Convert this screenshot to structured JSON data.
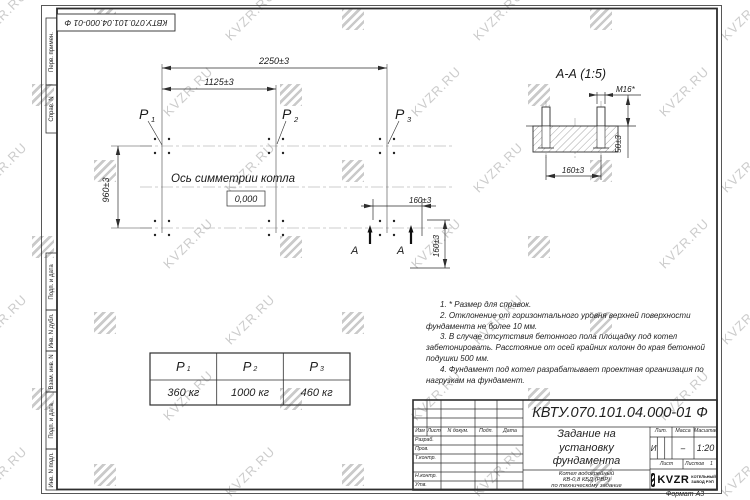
{
  "watermark": {
    "text": "KVZR.RU"
  },
  "corner_stamp": {
    "doc_number": "КВТУ.070.101.04.000-01 Ф"
  },
  "margin_fields": [
    "Перв. примен.",
    "Справ. N",
    "Подп. и дата",
    "Инв. N дубл.",
    "Взам. инв. N",
    "Подп. и дата",
    "Инв. N подл."
  ],
  "plan": {
    "dim_width": "2250±3",
    "dim_width_half": "1125±3",
    "dim_height": "960±3",
    "points": [
      {
        "name": "P",
        "sub": "1"
      },
      {
        "name": "P",
        "sub": "2"
      },
      {
        "name": "P",
        "sub": "3"
      }
    ],
    "axis_label": "Ось симметрии котла",
    "zero_level": "0,000",
    "dim_bolt_h": "160±3",
    "dim_bolt_v": "160±3",
    "section_letter": "А"
  },
  "section_view": {
    "title": "А-А (1:5)",
    "bolt_label": "М16*",
    "dim_protrusion": "50±3",
    "dim_spacing": "160±3"
  },
  "notes": [
    "1. * Размер для справок.",
    "2. Отклонение от горизонтального уровня верхней поверхности фундамента не более 10 мм.",
    "3. В случае отсутствия бетонного пола площадку под котел забетонировать. Расстояние от осей крайних колонн до края бетонной подушки 500 мм.",
    "4. Фундамент под котел разрабатывает проектная организация по нагрузкам на фундамент."
  ],
  "load_table": {
    "headers": [
      {
        "name": "P",
        "sub": "1"
      },
      {
        "name": "P",
        "sub": "2"
      },
      {
        "name": "P",
        "sub": "3"
      }
    ],
    "values": [
      "360 кг",
      "1000 кг",
      "460 кг"
    ]
  },
  "title_block": {
    "doc_number": "КВТУ.070.101.04.000-01 Ф",
    "title_lines": [
      "Задание на",
      "установку",
      "фундамента"
    ],
    "product_lines": [
      "Котел водогрейный",
      "КВ-0,8 КБД (РВР)",
      "по техническому задание"
    ],
    "col_headers": [
      "Изм",
      "Лист",
      "N докум.",
      "Подп.",
      "Дата"
    ],
    "sig_rows": [
      "Разраб.",
      "Пров.",
      "Т.контр.",
      "",
      "Н.контр.",
      "Утв."
    ],
    "lit_label": "Лит.",
    "lit_value": "И",
    "mass_label": "Масса",
    "mass_value": "–",
    "scale_label": "Масштаб",
    "scale_value": "1:20",
    "sheet_label": "Лист",
    "sheets_label": "Листов",
    "sheets_value": "1",
    "logo_text": "KVZR",
    "company_lines": [
      "КОТЕЛЬНЫЙ",
      "ЗАВОД РЭП"
    ]
  },
  "format_label": "Формат А3"
}
